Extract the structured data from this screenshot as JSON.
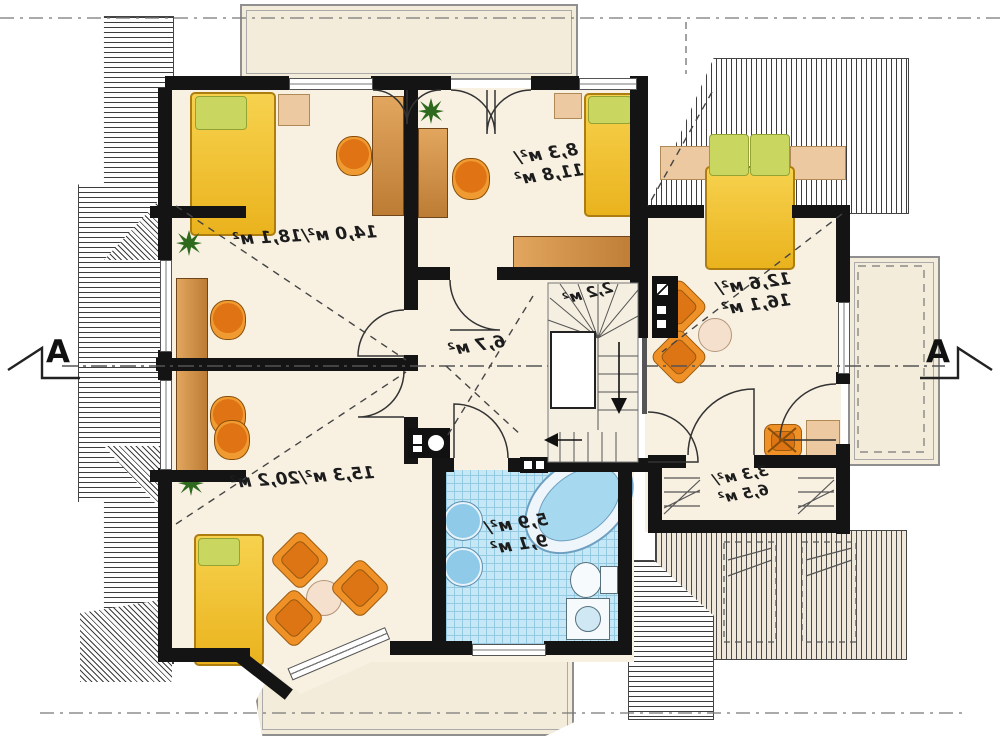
{
  "plan": {
    "type": "floor-plan",
    "storey": "attic",
    "mirrored": true,
    "section_markers": {
      "left": "A",
      "right": "A"
    },
    "rooms": [
      {
        "id": "bedroom-top-left",
        "area": "14,0 м²/18,1 м²"
      },
      {
        "id": "bedroom-top-middle",
        "area_line1": "8,3 м²/",
        "area_line2": "11,8 м²"
      },
      {
        "id": "bedroom-right",
        "area_line1": "12,6 м²/",
        "area_line2": "16,1 м²"
      },
      {
        "id": "staircase",
        "area": "2,2 м²"
      },
      {
        "id": "hall",
        "area": "6,7 м²"
      },
      {
        "id": "bedroom-bottom-left",
        "area": "15,3 м²/20,2 м²"
      },
      {
        "id": "bathroom",
        "area_line1": "5,9 м²/",
        "area_line2": "9,1 м²"
      },
      {
        "id": "wardrobe",
        "area_line1": "3,3 м²/",
        "area_line2": "6,5 м²"
      }
    ],
    "colors": {
      "floor": "#f8f1e2",
      "wall": "#141414",
      "bed": "#f2c53a",
      "pillow": "#c9d65f",
      "furniture_wood": "#cd8f47",
      "chair": "#ef9126",
      "bath_tile": "#c6e7f6",
      "roof_hatch_line": "#3c3c3c"
    }
  }
}
